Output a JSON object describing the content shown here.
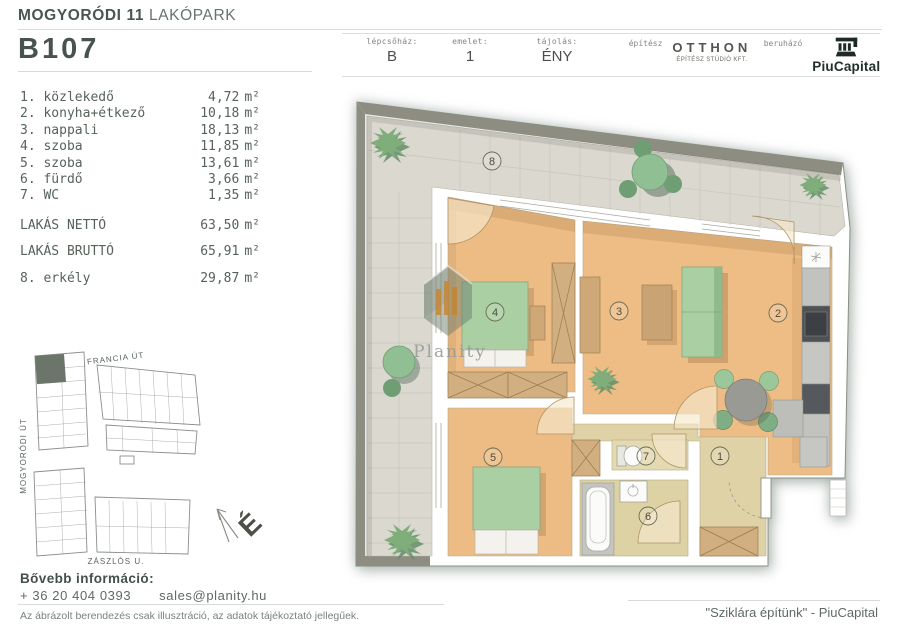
{
  "page": {
    "bg": "#ffffff",
    "accent": "#47524c",
    "muted": "#6d7a73",
    "wood": "#ecbc84",
    "green": "#a9cfa2",
    "tile": "#dbd8d0"
  },
  "header": {
    "title_bold": "MOGYORÓDI 11",
    "title_rest": "LAKÓPARK",
    "unit_id": "B107",
    "info": [
      {
        "label": "lépcsőház:",
        "value": "B"
      },
      {
        "label": "emelet:",
        "value": "1"
      },
      {
        "label": "tájolás:",
        "value": "ÉNY"
      },
      {
        "label": "építész",
        "value": "OTTHON",
        "value_sub": "ÉPÍTÉSZ STÚDIÓ KFT."
      },
      {
        "label": "beruházó",
        "value": "PiuCapital"
      }
    ]
  },
  "areas": {
    "unit": "m²",
    "rooms": [
      {
        "label": "1. közlekedő",
        "value": "4,72"
      },
      {
        "label": "2. konyha+étkező",
        "value": "10,18"
      },
      {
        "label": "3. nappali",
        "value": "18,13"
      },
      {
        "label": "4. szoba",
        "value": "11,85"
      },
      {
        "label": "5. szoba",
        "value": "13,61"
      },
      {
        "label": "6. fürdő",
        "value": "3,66"
      },
      {
        "label": "7. WC",
        "value": "1,35"
      }
    ],
    "totals": [
      {
        "label": "LAKÁS NETTÓ",
        "value": "63,50"
      },
      {
        "label": "LAKÁS BRUTTÓ",
        "value": "65,91"
      }
    ],
    "extra": {
      "label": "8. erkély",
      "value": "29,87"
    }
  },
  "sitemap": {
    "street_top": "FRANCIA ÚT",
    "street_left": "MOGYORÓDI ÚT",
    "street_bottom": "ZÁSZLÓS U."
  },
  "compass": {
    "north": "É"
  },
  "plan": {
    "numbers": [
      "1",
      "2",
      "3",
      "4",
      "5",
      "6",
      "7",
      "8"
    ],
    "watermark": "Planity"
  },
  "contact": {
    "heading": "Bővebb információ:",
    "phone": "+ 36 20 404 0393",
    "email": "sales@planity.hu"
  },
  "disclaimer": "Az ábrázolt berendezés csak illusztráció, az adatok tájékoztató jellegűek.",
  "footer_quote": "\"Sziklára építünk\" - PiuCapital"
}
